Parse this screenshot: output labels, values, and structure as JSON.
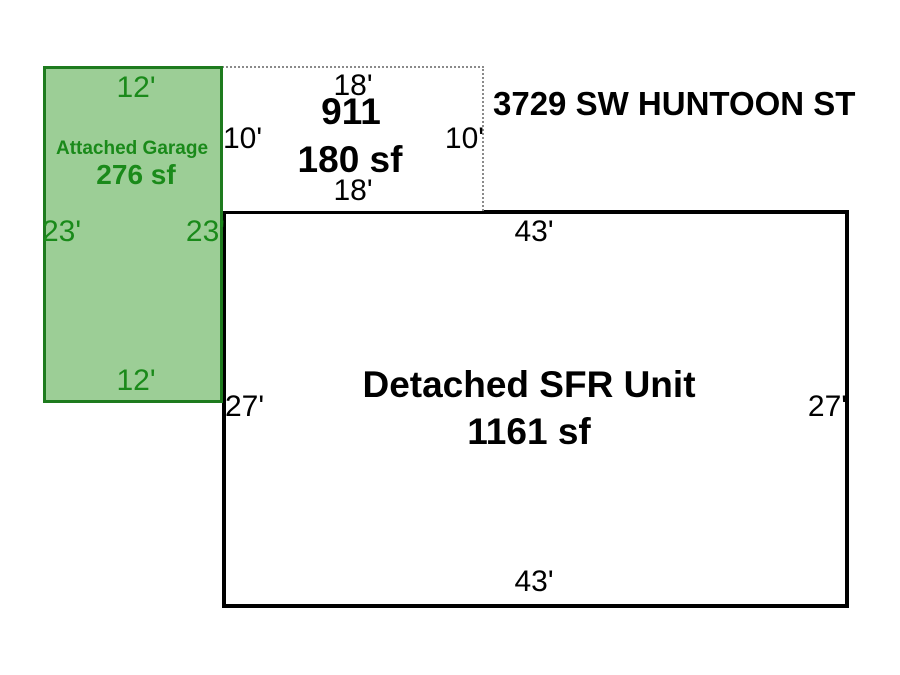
{
  "sketch": {
    "address": "3729 SW HUNTOON ST",
    "sections": [
      {
        "id": "attached_garage",
        "name": "Attached Garage",
        "area_label": "276 sf",
        "dimensions": {
          "top": "12'",
          "bottom": "12'",
          "left": "23'",
          "right": "23'"
        }
      },
      {
        "id": "porch_911",
        "name": "911",
        "area_label": "180 sf",
        "dimensions": {
          "top": "18'",
          "bottom": "18'",
          "left": "10'",
          "right": "10'"
        }
      },
      {
        "id": "detached_sfr",
        "name": "Detached SFR Unit",
        "area_label": "1161 sf",
        "dimensions": {
          "top": "43'",
          "bottom": "43'",
          "left": "27'",
          "right": "27'"
        }
      }
    ]
  },
  "colors": {
    "garage_fill": "#9cce96",
    "garage_border": "#1e7b1e",
    "garage_text": "#1a8a1a",
    "sfr_outline": "#000000",
    "porch_dotted": "#8a8a8a",
    "background": "#ffffff"
  }
}
